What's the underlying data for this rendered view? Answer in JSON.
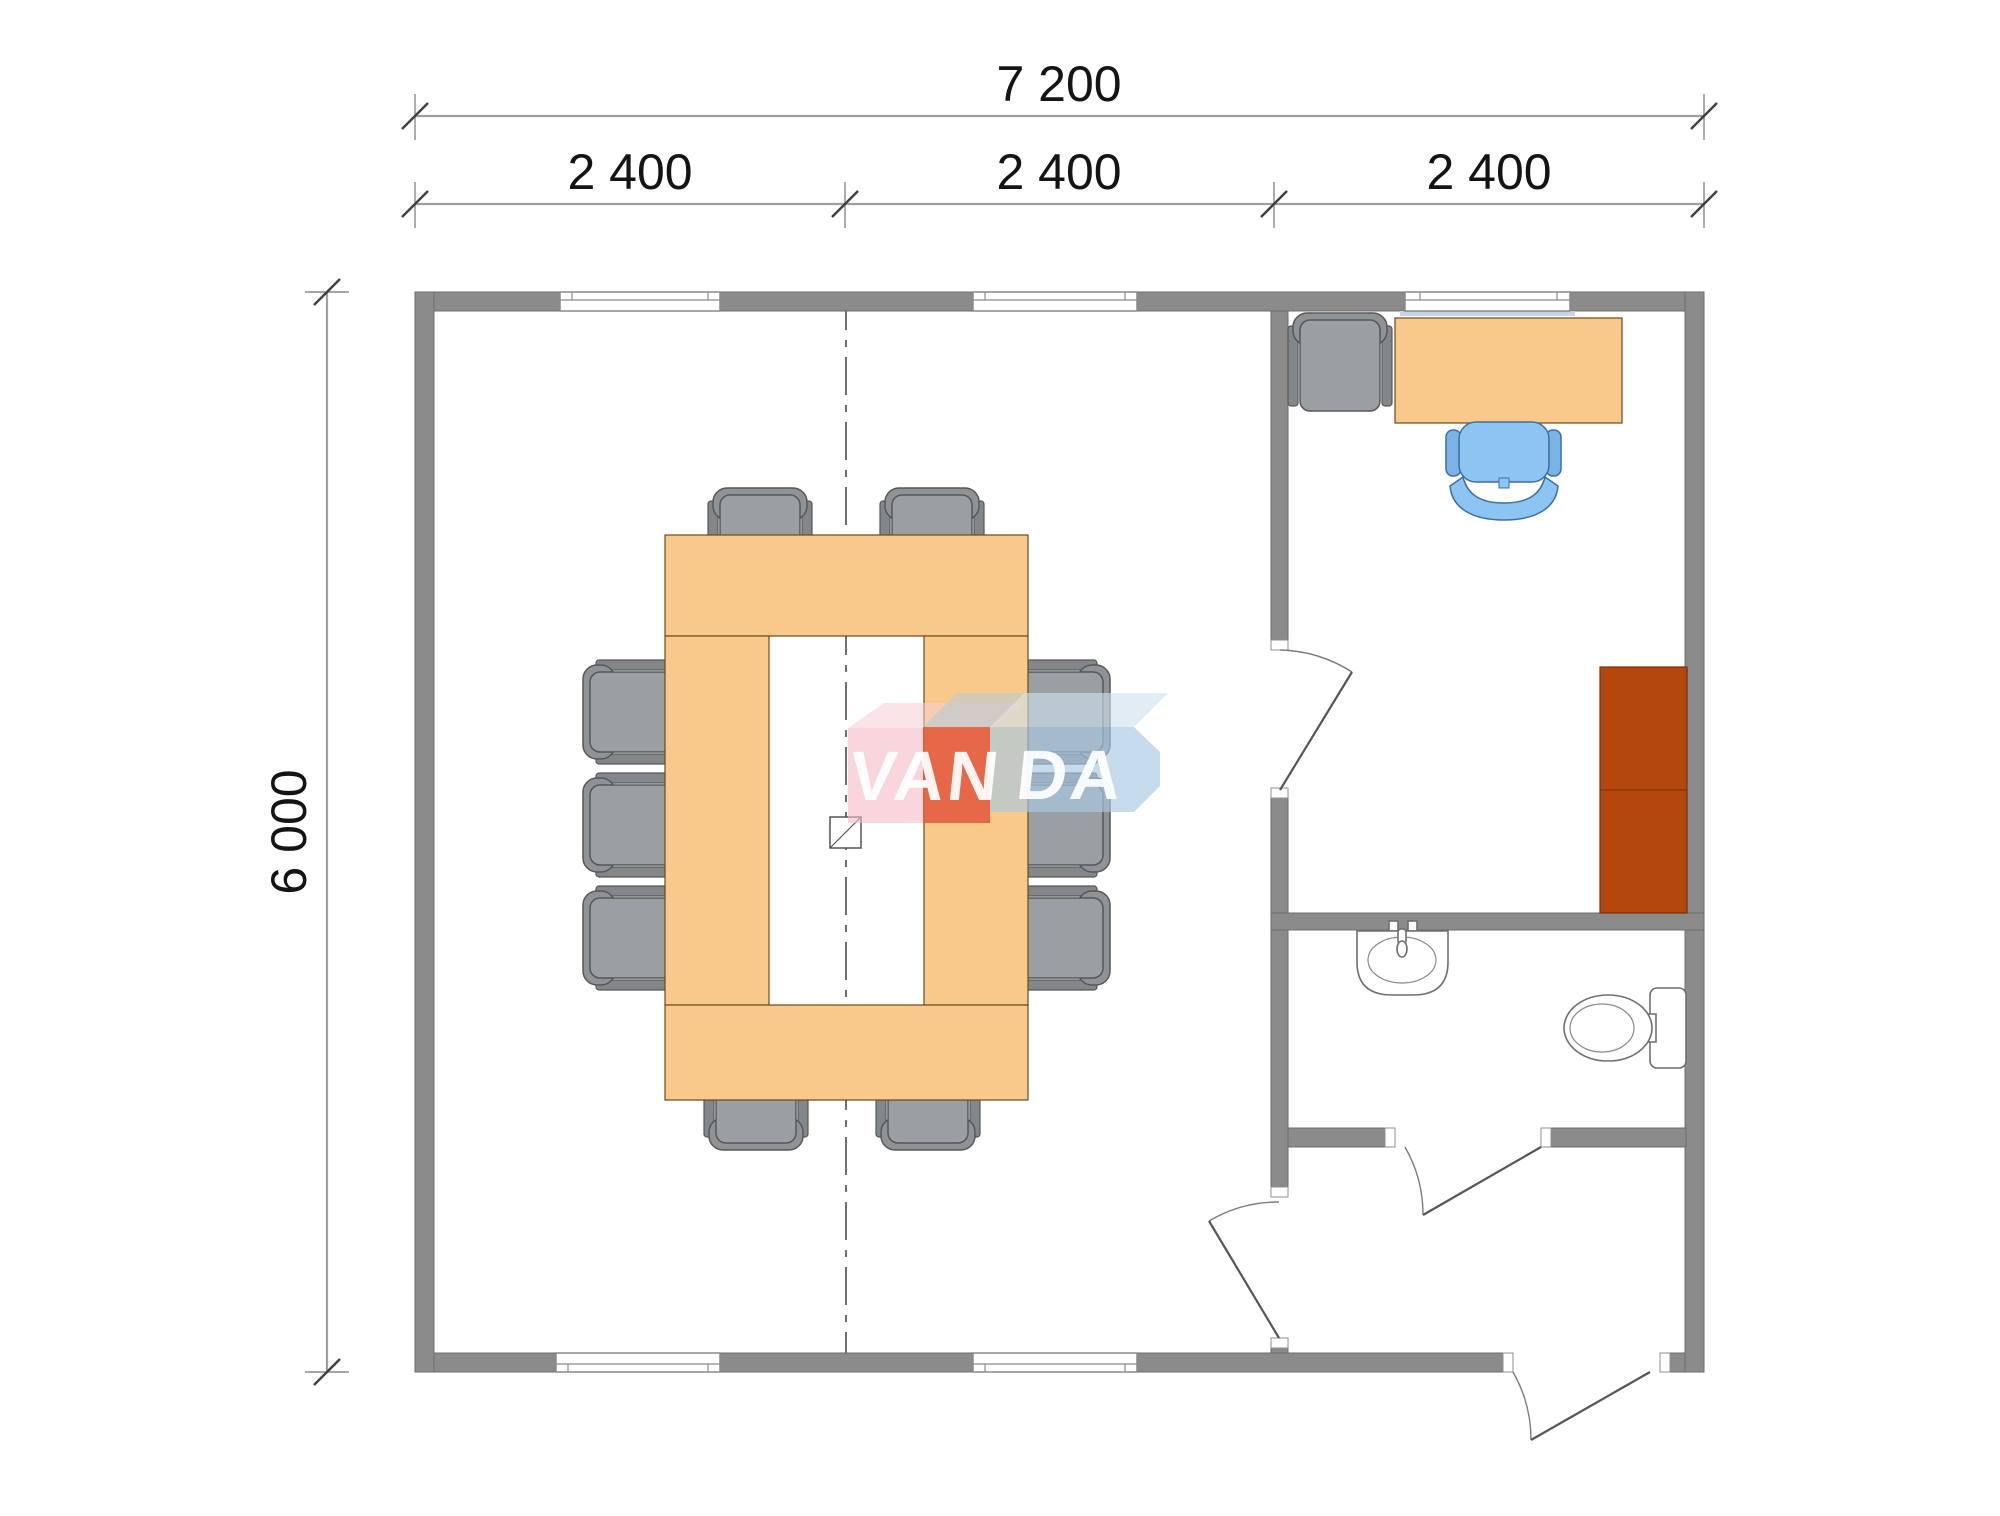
{
  "drawing": {
    "kind": "architectural floor plan",
    "dimensions": {
      "total_width_label": "7 200",
      "module_labels": [
        "2 400",
        "2 400",
        "2 400"
      ],
      "total_height_label": "6 000"
    },
    "watermark": {
      "brand": "VANDA",
      "left_text": "VAN",
      "right_text": "DA"
    },
    "colors": {
      "wall_gray": "#8b8b8b",
      "table_tan": "#f9c98b",
      "cabinet_brown": "#b4470e",
      "desk_chair_blue": "#8cc4f2",
      "chair_gray": "#9aa0a2",
      "watermark_pink": "rgba(243,186,195,0.60)",
      "watermark_pink_bevel": "rgba(245,205,212,0.55)",
      "watermark_red": "rgba(224,73,37,0.74)",
      "watermark_blue": "rgba(168,200,226,0.66)",
      "watermark_blue_bevel": "rgba(206,224,238,0.62)",
      "watermark_cube_bevel": "rgba(183,201,213,0.60)",
      "window_sill_blue": "#c6d6e8"
    }
  }
}
